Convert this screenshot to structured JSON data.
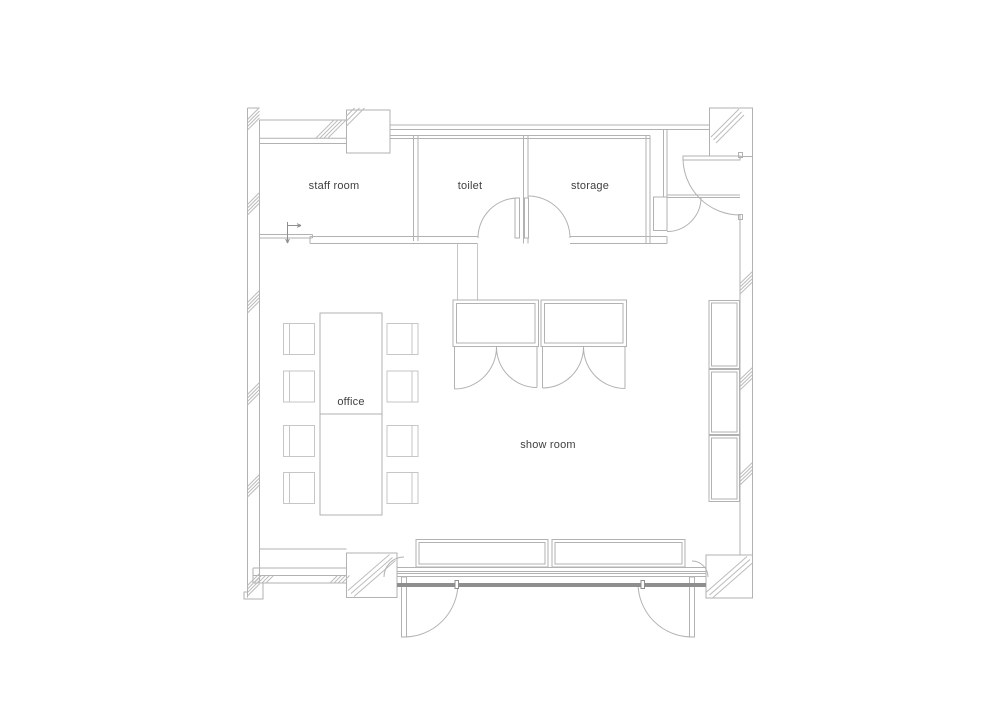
{
  "floor_plan": {
    "rooms": {
      "staff_room": {
        "label": "staff room"
      },
      "toilet": {
        "label": "toilet"
      },
      "storage": {
        "label": "storage"
      },
      "office": {
        "label": "office"
      },
      "show_room": {
        "label": "show room"
      }
    },
    "colors": {
      "wall": "#b2b2b2",
      "hatch": "#bcbcbc",
      "light_detail": "#c6c6c6",
      "dark_detail": "#8e8e8e",
      "label_text": "#3f3f3f",
      "background": "#ffffff"
    }
  }
}
